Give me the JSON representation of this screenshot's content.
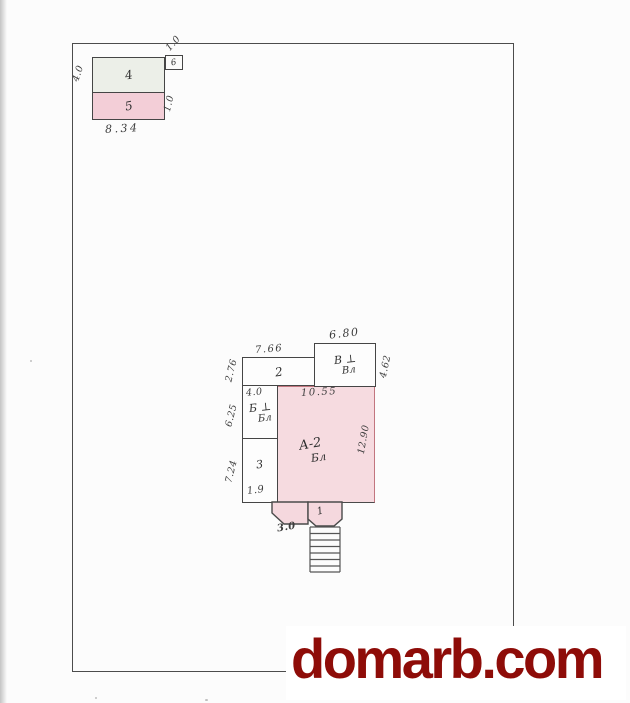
{
  "watermark": {
    "text": "domarb.com"
  },
  "colors": {
    "watermark_red": "#8e0c08",
    "ink": "#454545",
    "pink_fill": "#f6dbe0",
    "pink_outline": "#c2767f",
    "room4_fill": "#ecefe8",
    "paper": "#fcfcfc"
  },
  "plan": {
    "outbuilding": {
      "room4_label": "4",
      "room5_label": "5",
      "annex_label": "6",
      "dim_left": "4.0",
      "dim_bottom": "8.34",
      "dim_right": "1.0",
      "dim_annex": "1.0"
    },
    "main": {
      "room2_label": "2",
      "roomV_label1": "В ⊥",
      "roomV_label2": "Вл",
      "roomB_label1": "Б ⊥",
      "roomB_label2": "Бл",
      "room3_label": "3",
      "roomA_label1": "А-2",
      "roomA_label2": "Бл",
      "porch_label": "1",
      "dim_top_left": "7.66",
      "dim_top_right": "6.80",
      "dim_left_upper": "2.76",
      "dim_right_upper": "4.62",
      "dim_b_top": "4.0",
      "dim_pink_top": "10.55",
      "dim_left_mid": "6.25",
      "dim_left_lower": "7.24",
      "dim_room3_bottom": "1.9",
      "dim_pink_right": "12.90",
      "dim_porch": "3.0"
    }
  }
}
